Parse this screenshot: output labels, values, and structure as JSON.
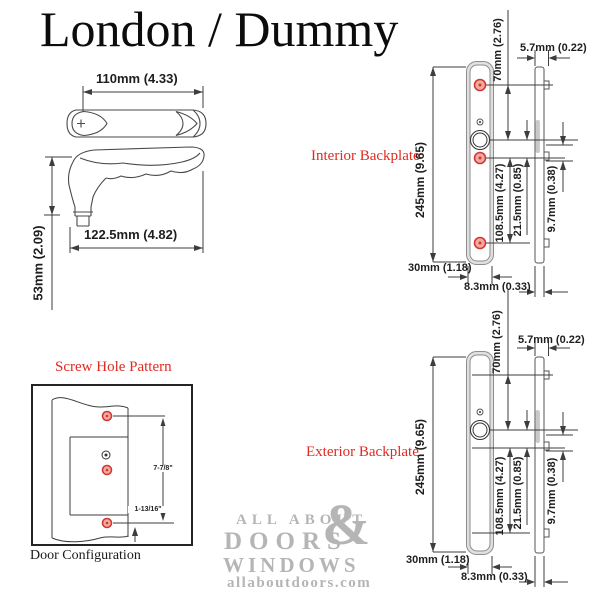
{
  "title": "London / Dummy",
  "colors": {
    "accent_red": "#e02a22",
    "line": "#3d3d3d",
    "watermark_gray": "#b5b5b5",
    "screw_hole_fill": "#f4a9a4"
  },
  "handle": {
    "width_dim": "110mm (4.33)",
    "depth_dim": "122.5mm (4.82)",
    "height_dim": "53mm (2.09)"
  },
  "screw_pattern": {
    "title": "Screw Hole Pattern",
    "long_dim": "7-7/8\"",
    "short_dim": "1-13/16\"",
    "caption": "Door Configuration"
  },
  "backplate": {
    "interior_label": "Interior Backplate",
    "exterior_label": "Exterior Backplate",
    "height": "245mm (9.65)",
    "top_to_cylinder": "70mm (2.76)",
    "profile_tab": "5.7mm (0.22)",
    "hole_span": "108.5mm (4.27)",
    "cylinder_to_hole": "21.5mm (0.85)",
    "profile_offset": "9.7mm (0.38)",
    "plate_width": "30mm (1.18)",
    "profile_width": "8.3mm (0.33)"
  },
  "watermark": {
    "line1": "ALL ABOUT",
    "amp": "&",
    "line2": "DOORS",
    "line3": "WINDOWS",
    "line4": "allaboutdoors.com"
  }
}
